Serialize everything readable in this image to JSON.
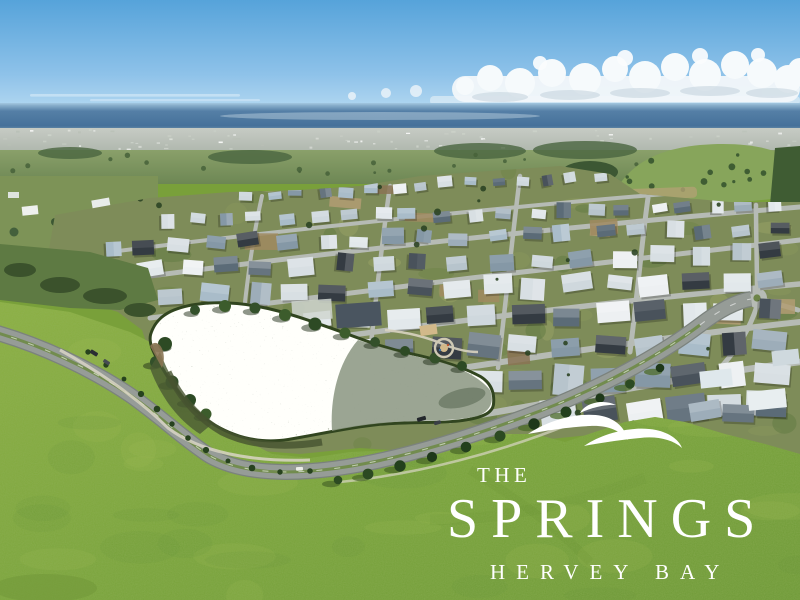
{
  "meta": {
    "type": "aerial-drone-photograph",
    "description": "Oblique aerial photo of The Springs master-planned housing estate at Hervey Bay: clear blue sky with a cumulus cloud bank, ocean on the horizon, hazy distant township, dense new suburb with grey and white roofs, a sparkling lake ringed by trees, a curving tree-lined boulevard and a large bright green open field carrying the white estate logo."
  },
  "logo": {
    "line1": "THE",
    "line2": "SPRINGS",
    "line3": "HERVEY BAY",
    "icon": "triple-wave-icon",
    "text_color": "#ffffff"
  },
  "scene": {
    "palette": {
      "sky_top": "#5fa9dd",
      "sky_horizon": "#cde7f6",
      "cloud": "#f6fafc",
      "cloud_shadow": "#c3d2dc",
      "ocean": "#48769f",
      "ocean_light": "#9ec2da",
      "haze_city": "#bfc5bf",
      "distant_green": "#7b945e",
      "forest": "#3c5733",
      "hill_green": "#87a55b",
      "estate_ground": "#7e8c59",
      "street": "#b6bbb5",
      "roofs": [
        "#edf0f2",
        "#e2e8eb",
        "#cfd8dd",
        "#b7c4cc",
        "#9dadb9",
        "#8598a6",
        "#66747f",
        "#49525b",
        "#343b42",
        "#a9bcc9",
        "#d8dfe3",
        "#5b6b77"
      ],
      "lawn_tones": [
        "#6d8448",
        "#87965c",
        "#97a266",
        "#5f7a42"
      ],
      "field": "#7fa43c",
      "field_light": "#a8c05a",
      "field_dark": "#5f8a33",
      "lake_base": "#aab3a2",
      "lake_dark": "#8d9884",
      "shore": "#31451f",
      "road": "#969c97",
      "road_median": "#6e8b46",
      "footpath": "#d9d5c5",
      "tree": "#27421e",
      "tree_shadow": "#4c6b2a",
      "dirt": "#b19c73",
      "sand": "#d2b98a"
    }
  }
}
